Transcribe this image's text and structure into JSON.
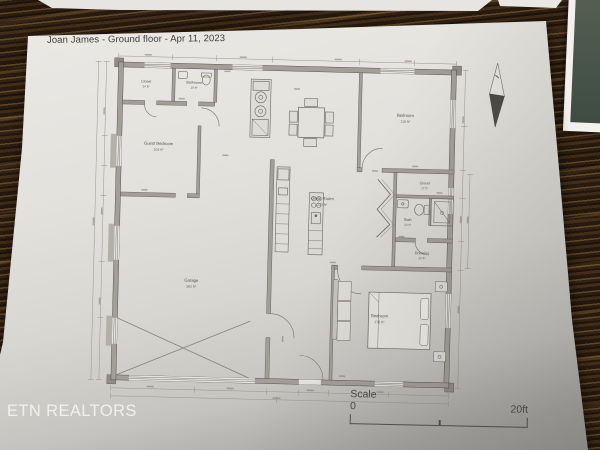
{
  "document": {
    "title": "Joan James - Ground floor - Apr 11, 2023",
    "watermark": "ETN REALTORS",
    "scale": {
      "label": "Scale",
      "min": "0",
      "max": "20ft"
    }
  },
  "floor_plan": {
    "rooms": {
      "closet_tl": {
        "name": "Closet",
        "area": "24 ft²"
      },
      "bathroom_tl": {
        "name": "Bathroom",
        "area": "19 ft²"
      },
      "guest_bedroom": {
        "name": "Guest Bedroom",
        "area": "104 ft²"
      },
      "great_room": {
        "name": "Great Room",
        "area": "233 ft²"
      },
      "garage": {
        "name": "Garage",
        "area": "362 ft²"
      },
      "bedroom_top": {
        "name": "Bedroom",
        "area": "118 ft²"
      },
      "closet_r": {
        "name": "Closet",
        "area": "17 ft²"
      },
      "bath_r": {
        "name": "Bath",
        "area": "20 ft²"
      },
      "dressing": {
        "name": "Dressing",
        "area": "20 ft²"
      },
      "bedroom_bottom": {
        "name": "Bedroom",
        "area": "178 ft²"
      }
    },
    "elements": [
      "north-arrow",
      "dining-table",
      "kitchen-island",
      "kitchen-counter",
      "laundry-appliances",
      "bed",
      "sofa",
      "toilet",
      "sink",
      "shower",
      "stairs",
      "garage-cross-brace"
    ]
  },
  "colors": {
    "wood_dark": "#2c1c0e",
    "wood_mid": "#4a3420",
    "wood_light": "#8a6a42",
    "paper": "#e3e1dc",
    "paper_shadow": "#9d9b97",
    "ink": "#4a4846",
    "wall_gray": "#a29e98",
    "photo_green": "#4e5a4c",
    "watermark_white": "#f3f2f0"
  }
}
